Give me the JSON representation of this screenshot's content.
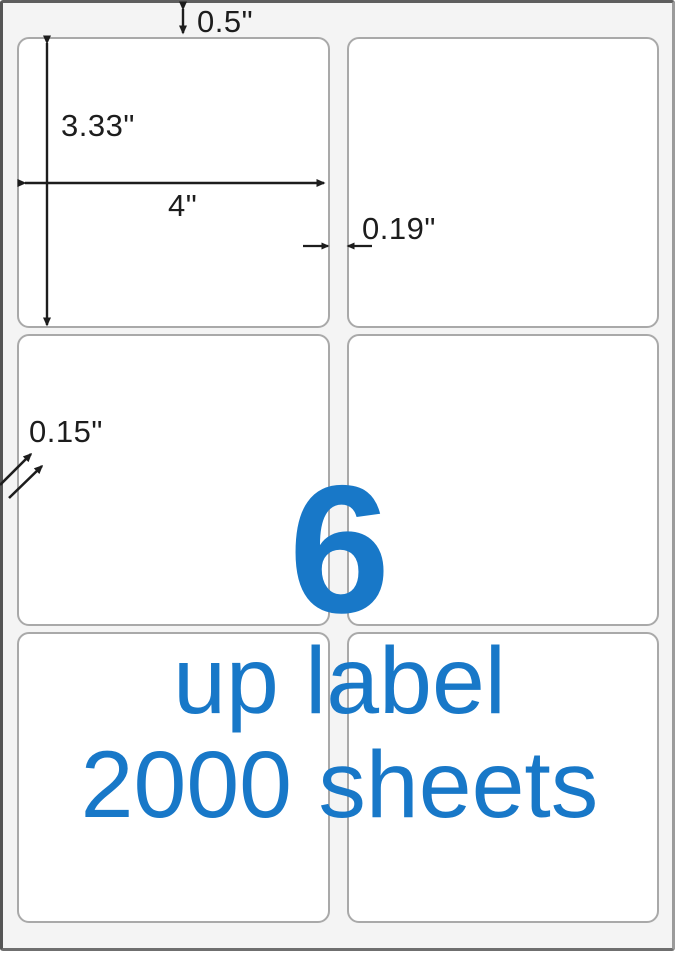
{
  "product_image": {
    "grid": {
      "rows": 3,
      "cols": 2
    },
    "dimensions": {
      "top_margin": "0.5\"",
      "label_height": "3.33\"",
      "label_width": "4\"",
      "column_gap": "0.19\"",
      "corner_radius": "0.15\""
    },
    "overlay": {
      "count": "6",
      "line1": "up label",
      "line2": "2000 sheets"
    },
    "colors": {
      "accent": "#1878c8",
      "sheet_background": "#f4f4f4",
      "label_border": "#a9a9a9",
      "dimension_ink": "#1d1d1d"
    }
  }
}
